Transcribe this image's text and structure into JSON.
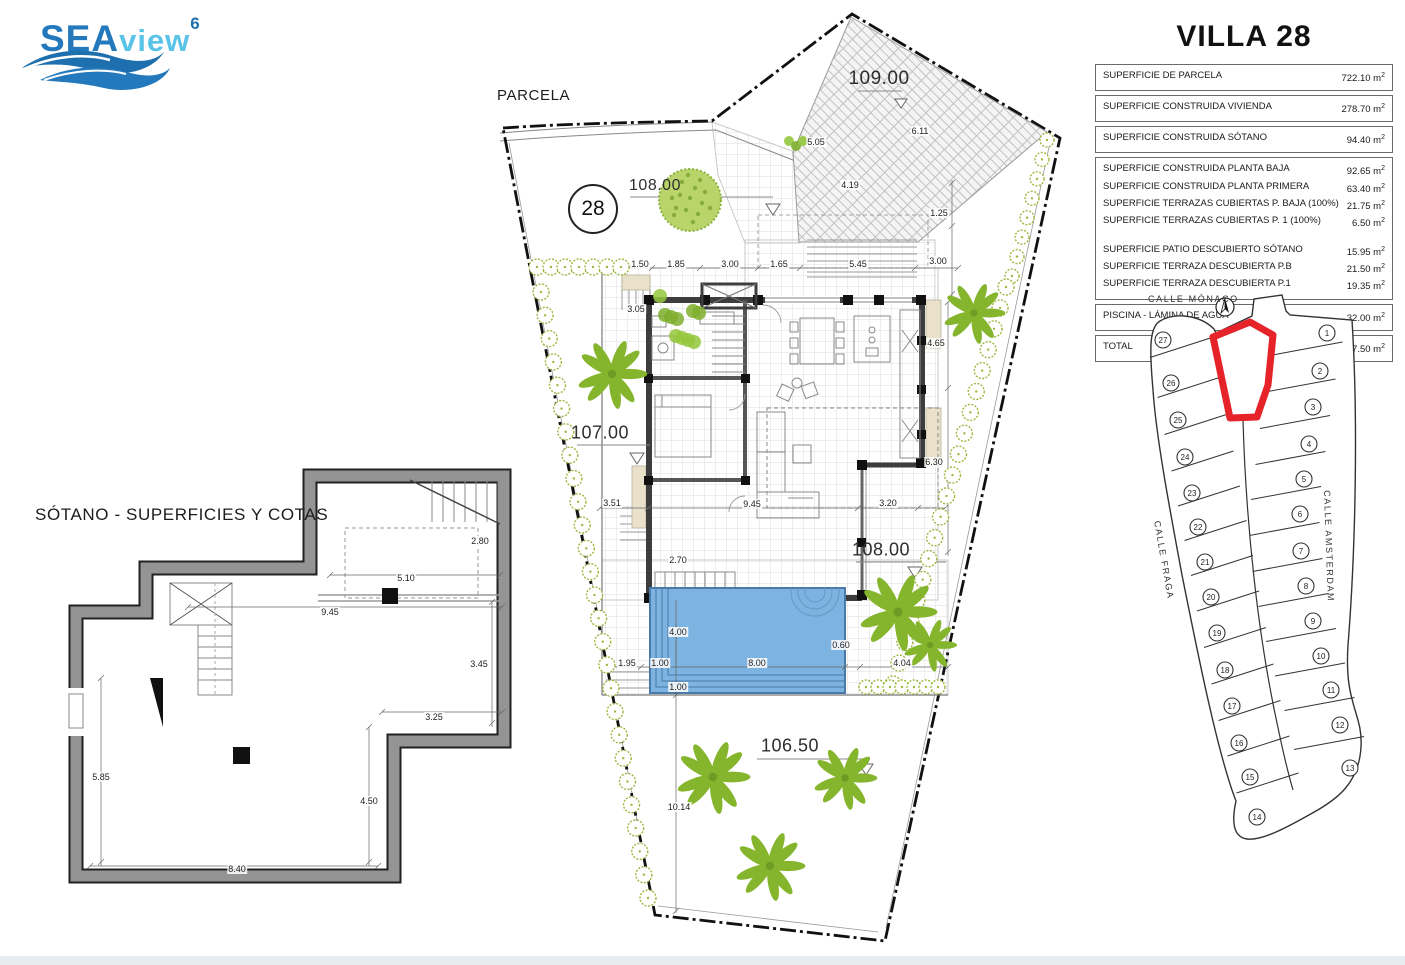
{
  "logo": {
    "sea": "SEA",
    "view": "view",
    "sup": "6"
  },
  "labels": {
    "parcela": "PARCELA",
    "sotano": "SÓTANO - SUPERFICIES Y COTAS",
    "plot_number": "28"
  },
  "villa": {
    "title": "VILLA 28",
    "unit": "m",
    "groups": [
      [
        {
          "label": "SUPERFICIE DE PARCELA",
          "value": "722.10"
        }
      ],
      [
        {
          "label": "SUPERFICIE CONSTRUIDA VIVIENDA",
          "value": "278.70"
        }
      ],
      [
        {
          "label": "SUPERFICIE CONSTRUIDA SÓTANO",
          "value": "94.40"
        }
      ],
      [
        {
          "label": "SUPERFICIE CONSTRUIDA PLANTA BAJA",
          "value": "92.65"
        },
        {
          "label": "SUPERFICIE CONSTRUIDA PLANTA PRIMERA",
          "value": "63.40"
        },
        {
          "label": "SUPERFICIE TERRAZAS CUBIERTAS P. BAJA (100%)",
          "value": "21.75"
        },
        {
          "label": "SUPERFICIE TERRAZAS CUBIERTAS P. 1 (100%)",
          "value": "6.50"
        },
        {
          "spacer": true
        },
        {
          "label": "SUPERFICIE PATIO DESCUBIERTO SÓTANO",
          "value": "15.95"
        },
        {
          "label": "SUPERFICIE TERRAZA DESCUBIERTA P.B",
          "value": "21.50"
        },
        {
          "label": "SUPERFICIE TERRAZA DESCUBIERTA P.1",
          "value": "19.35"
        }
      ],
      [
        {
          "label": "PISCINA - LÁMINA DE AGUA",
          "value": "32.00"
        }
      ],
      [
        {
          "label": "TOTAL",
          "value": "367.50"
        }
      ]
    ]
  },
  "site": {
    "levels": [
      {
        "t": "109.00",
        "x": 879,
        "y": 79,
        "s": 19
      },
      {
        "t": "108.00",
        "x": 655,
        "y": 186,
        "s": 16
      },
      {
        "t": "107.00",
        "x": 600,
        "y": 433,
        "s": 18
      },
      {
        "t": "108.00",
        "x": 881,
        "y": 550,
        "s": 18
      },
      {
        "t": "106.50",
        "x": 790,
        "y": 746,
        "s": 18
      }
    ],
    "dims": [
      {
        "t": "1.50",
        "x": 640,
        "y": 264
      },
      {
        "t": "1.85",
        "x": 676,
        "y": 264
      },
      {
        "t": "3.00",
        "x": 730,
        "y": 264
      },
      {
        "t": "1.65",
        "x": 779,
        "y": 264
      },
      {
        "t": "5.45",
        "x": 858,
        "y": 264
      },
      {
        "t": "3.00",
        "x": 938,
        "y": 261
      },
      {
        "t": "3.05",
        "x": 636,
        "y": 309
      },
      {
        "t": "5.05",
        "x": 816,
        "y": 142
      },
      {
        "t": "6.11",
        "x": 920,
        "y": 131
      },
      {
        "t": "4.19",
        "x": 850,
        "y": 185
      },
      {
        "t": "1.25",
        "x": 939,
        "y": 213
      },
      {
        "t": "4.65",
        "x": 936,
        "y": 343
      },
      {
        "t": "6.30",
        "x": 934,
        "y": 462
      },
      {
        "t": "3.51",
        "x": 612,
        "y": 503
      },
      {
        "t": "9.45",
        "x": 752,
        "y": 504
      },
      {
        "t": "3.20",
        "x": 888,
        "y": 503
      },
      {
        "t": "2.70",
        "x": 678,
        "y": 560
      },
      {
        "t": "4.00",
        "x": 678,
        "y": 632
      },
      {
        "t": "1.95",
        "x": 627,
        "y": 663
      },
      {
        "t": "1.00",
        "x": 660,
        "y": 663
      },
      {
        "t": "8.00",
        "x": 757,
        "y": 663
      },
      {
        "t": "0.60",
        "x": 841,
        "y": 645
      },
      {
        "t": "1.00",
        "x": 678,
        "y": 687
      },
      {
        "t": "4.04",
        "x": 902,
        "y": 663
      },
      {
        "t": "10.14",
        "x": 679,
        "y": 807
      },
      {
        "t": "2.80",
        "x": 480,
        "y": 541
      },
      {
        "t": "5.10",
        "x": 406,
        "y": 578
      },
      {
        "t": "9.45",
        "x": 330,
        "y": 612
      },
      {
        "t": "3.45",
        "x": 479,
        "y": 664
      },
      {
        "t": "3.25",
        "x": 434,
        "y": 717
      },
      {
        "t": "4.50",
        "x": 369,
        "y": 801
      },
      {
        "t": "8.40",
        "x": 237,
        "y": 869
      },
      {
        "t": "5.85",
        "x": 101,
        "y": 777
      }
    ],
    "shrub_rows": [
      {
        "x1": 537,
        "y1": 267,
        "x2": 621,
        "y2": 267,
        "n": 7,
        "r": 8
      },
      {
        "x1": 541,
        "y1": 292,
        "x2": 648,
        "y2": 898,
        "n": 27,
        "r": 8
      },
      {
        "x1": 1047,
        "y1": 140,
        "x2": 1012,
        "y2": 276,
        "n": 8,
        "r": 7
      },
      {
        "x1": 1006,
        "y1": 287,
        "x2": 893,
        "y2": 684,
        "n": 20,
        "r": 8
      },
      {
        "x1": 866,
        "y1": 687,
        "x2": 938,
        "y2": 687,
        "n": 7,
        "r": 7
      }
    ],
    "palms": [
      {
        "x": 612,
        "y": 374,
        "r": 34
      },
      {
        "x": 974,
        "y": 313,
        "r": 30
      },
      {
        "x": 898,
        "y": 612,
        "r": 38
      },
      {
        "x": 930,
        "y": 645,
        "r": 26
      },
      {
        "x": 713,
        "y": 777,
        "r": 36
      },
      {
        "x": 845,
        "y": 778,
        "r": 31
      },
      {
        "x": 770,
        "y": 866,
        "r": 34
      }
    ],
    "colors": {
      "pool": "#7db3e0",
      "pool_edge": "#4a7aa8",
      "tree": "#85b52c",
      "shrub": "#9cb83e"
    }
  },
  "map": {
    "street_top": "CALLE MÓNACO",
    "street_left": "CALLE FRAGA",
    "street_right": "CALLE AMSTERDAM",
    "highlight_plot": "28",
    "highlight_color": "#e52329",
    "left_plots": [
      {
        "n": "27",
        "x": 33,
        "y": 55
      },
      {
        "n": "26",
        "x": 41,
        "y": 98
      },
      {
        "n": "25",
        "x": 48,
        "y": 135
      },
      {
        "n": "24",
        "x": 55,
        "y": 172
      },
      {
        "n": "23",
        "x": 62,
        "y": 208
      },
      {
        "n": "22",
        "x": 68,
        "y": 242
      },
      {
        "n": "21",
        "x": 75,
        "y": 277
      },
      {
        "n": "20",
        "x": 81,
        "y": 312
      },
      {
        "n": "19",
        "x": 87,
        "y": 348
      },
      {
        "n": "18",
        "x": 95,
        "y": 385
      },
      {
        "n": "17",
        "x": 102,
        "y": 421
      },
      {
        "n": "16",
        "x": 109,
        "y": 458
      },
      {
        "n": "15",
        "x": 120,
        "y": 492
      },
      {
        "n": "14",
        "x": 127,
        "y": 532
      }
    ],
    "right_plots": [
      {
        "n": "1",
        "x": 197,
        "y": 48
      },
      {
        "n": "2",
        "x": 190,
        "y": 86
      },
      {
        "n": "3",
        "x": 183,
        "y": 122
      },
      {
        "n": "4",
        "x": 179,
        "y": 159
      },
      {
        "n": "5",
        "x": 174,
        "y": 194
      },
      {
        "n": "6",
        "x": 170,
        "y": 229
      },
      {
        "n": "7",
        "x": 171,
        "y": 266
      },
      {
        "n": "8",
        "x": 176,
        "y": 301
      },
      {
        "n": "9",
        "x": 183,
        "y": 336
      },
      {
        "n": "10",
        "x": 191,
        "y": 371
      },
      {
        "n": "11",
        "x": 201,
        "y": 405
      },
      {
        "n": "12",
        "x": 210,
        "y": 440
      },
      {
        "n": "13",
        "x": 220,
        "y": 483
      }
    ]
  }
}
